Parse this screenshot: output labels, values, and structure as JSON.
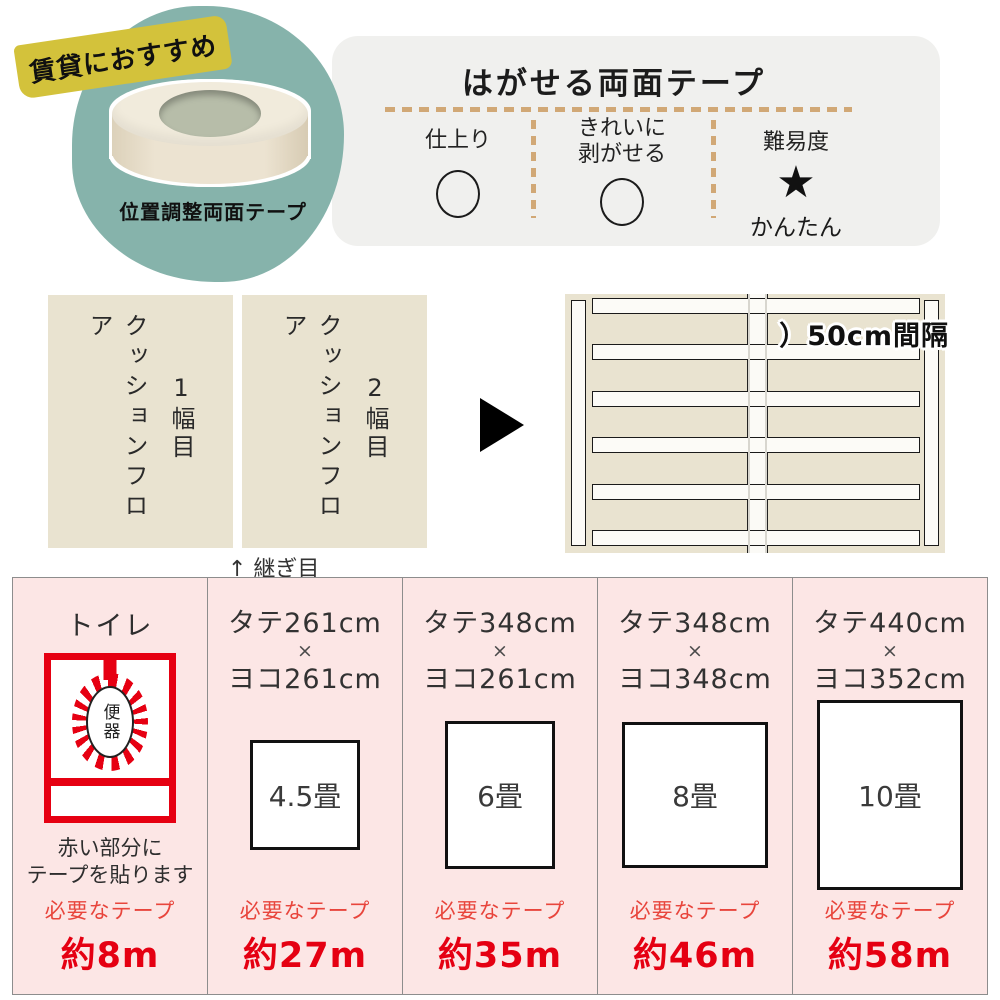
{
  "badge": {
    "label": "賃貸におすすめ"
  },
  "product": {
    "name": "位置調整両面テープ"
  },
  "spec_panel": {
    "title": "はがせる両面テープ",
    "col1_label": "仕上り",
    "col2_label_line1": "きれいに",
    "col2_label_line2": "剥がせる",
    "col3_label": "難易度",
    "col3_star": "★",
    "col3_note": "かんたん"
  },
  "sheets": {
    "sheet1_text": "クッションフロア",
    "sheet1_num": "1幅目",
    "sheet2_text": "クッションフロア",
    "sheet2_num": "2幅目",
    "seam_label": "↑ 継ぎ目"
  },
  "floor_diagram": {
    "interval_label": "）50cm間隔"
  },
  "rooms": [
    {
      "title": "トイレ",
      "toilet_label": "便器",
      "note_line1": "赤い部分に",
      "note_line2": "テープを貼ります",
      "tape_label": "必要なテープ",
      "tape_length": "約8m"
    },
    {
      "dim_height": "タテ261cm",
      "dim_sep": "×",
      "dim_width": "ヨコ261cm",
      "size_label": "4.5畳",
      "tape_label": "必要なテープ",
      "tape_length": "約27m"
    },
    {
      "dim_height": "タテ348cm",
      "dim_sep": "×",
      "dim_width": "ヨコ261cm",
      "size_label": "6畳",
      "tape_label": "必要なテープ",
      "tape_length": "約35m"
    },
    {
      "dim_height": "タテ348cm",
      "dim_sep": "×",
      "dim_width": "ヨコ348cm",
      "size_label": "8畳",
      "tape_label": "必要なテープ",
      "tape_length": "約46m"
    },
    {
      "dim_height": "タテ440cm",
      "dim_sep": "×",
      "dim_width": "ヨコ352cm",
      "size_label": "10畳",
      "tape_label": "必要なテープ",
      "tape_length": "約58m"
    }
  ],
  "colors": {
    "teal": "#86b3ab",
    "badge_yellow": "#d3c23b",
    "sheet_beige": "#e9e3d0",
    "panel_gray": "#f0f0ee",
    "dash_tan": "#d1a876",
    "room_pink": "#fce6e5",
    "accent_red": "#e50012",
    "toilet_red": "#e60012"
  }
}
